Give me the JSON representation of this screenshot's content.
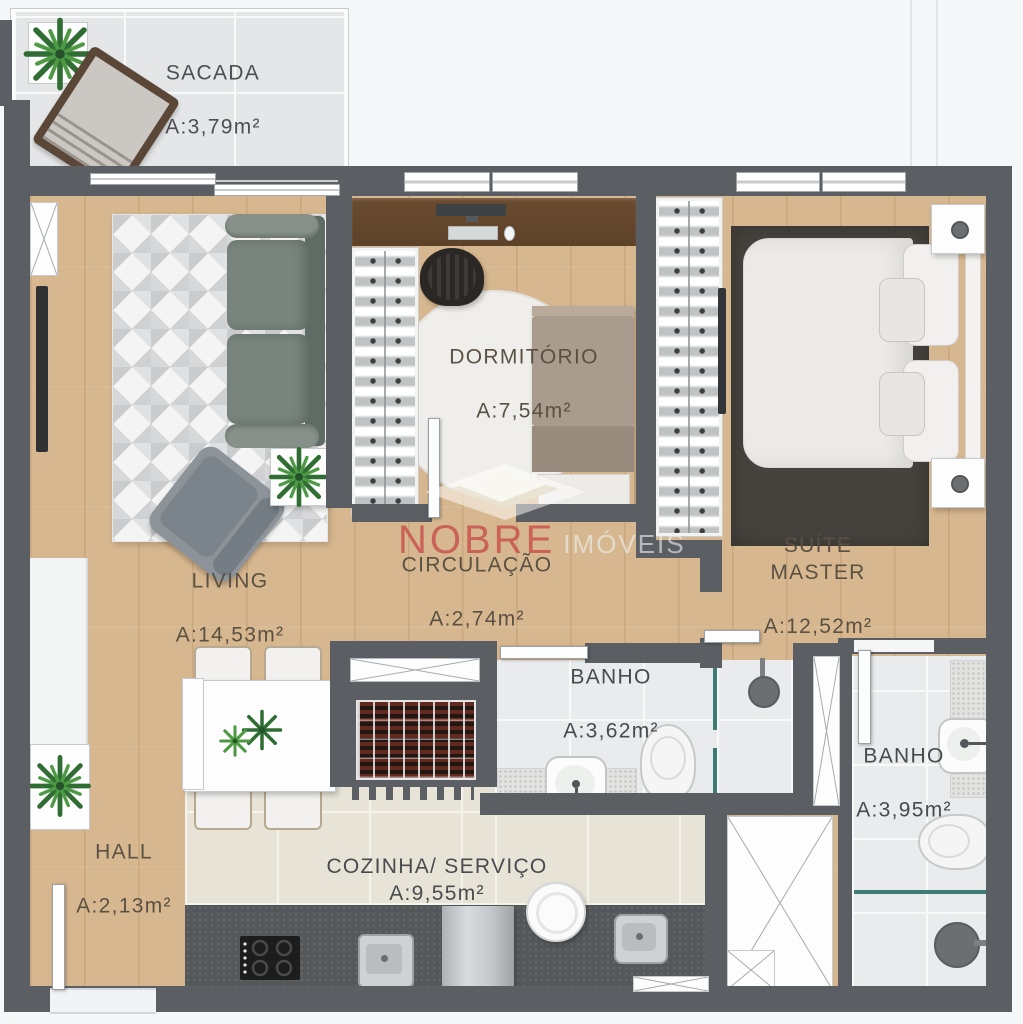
{
  "plan_title": "Apartment floor plan",
  "watermark": {
    "brand": "NOBRE",
    "brand_suffix": "IMÓVEIS"
  },
  "rooms": [
    {
      "id": "sacada",
      "name": "SACADA",
      "area": "A:3,79m²"
    },
    {
      "id": "living",
      "name": "LIVING",
      "area": "A:14,53m²"
    },
    {
      "id": "dormitorio",
      "name": "DORMITÓRIO",
      "area": "A:7,54m²"
    },
    {
      "id": "circulacao",
      "name": "CIRCULAÇÃO",
      "area": "A:2,74m²"
    },
    {
      "id": "suite",
      "name": "SUÍTE MASTER",
      "area": "A:12,52m²"
    },
    {
      "id": "banho_social",
      "name": "BANHO",
      "area": "A:3,62m²"
    },
    {
      "id": "banho_suite",
      "name": "BANHO",
      "area": "A:3,95m²"
    },
    {
      "id": "hall",
      "name": "HALL",
      "area": "A:2,13m²"
    },
    {
      "id": "cozinha",
      "name": "COZINHA/ SERVIÇO",
      "area": "A:9,55m²"
    }
  ],
  "colors": {
    "wall": "#5b5e62",
    "wood_floor": "#d7b78f",
    "gray_tile": "#e9ebec",
    "beige_tile": "#e7e4d7",
    "counter": "#55585a",
    "glass_partition": "#3c7c75",
    "brand_red": "#c74a4a",
    "dark_rug": "#46433e"
  }
}
